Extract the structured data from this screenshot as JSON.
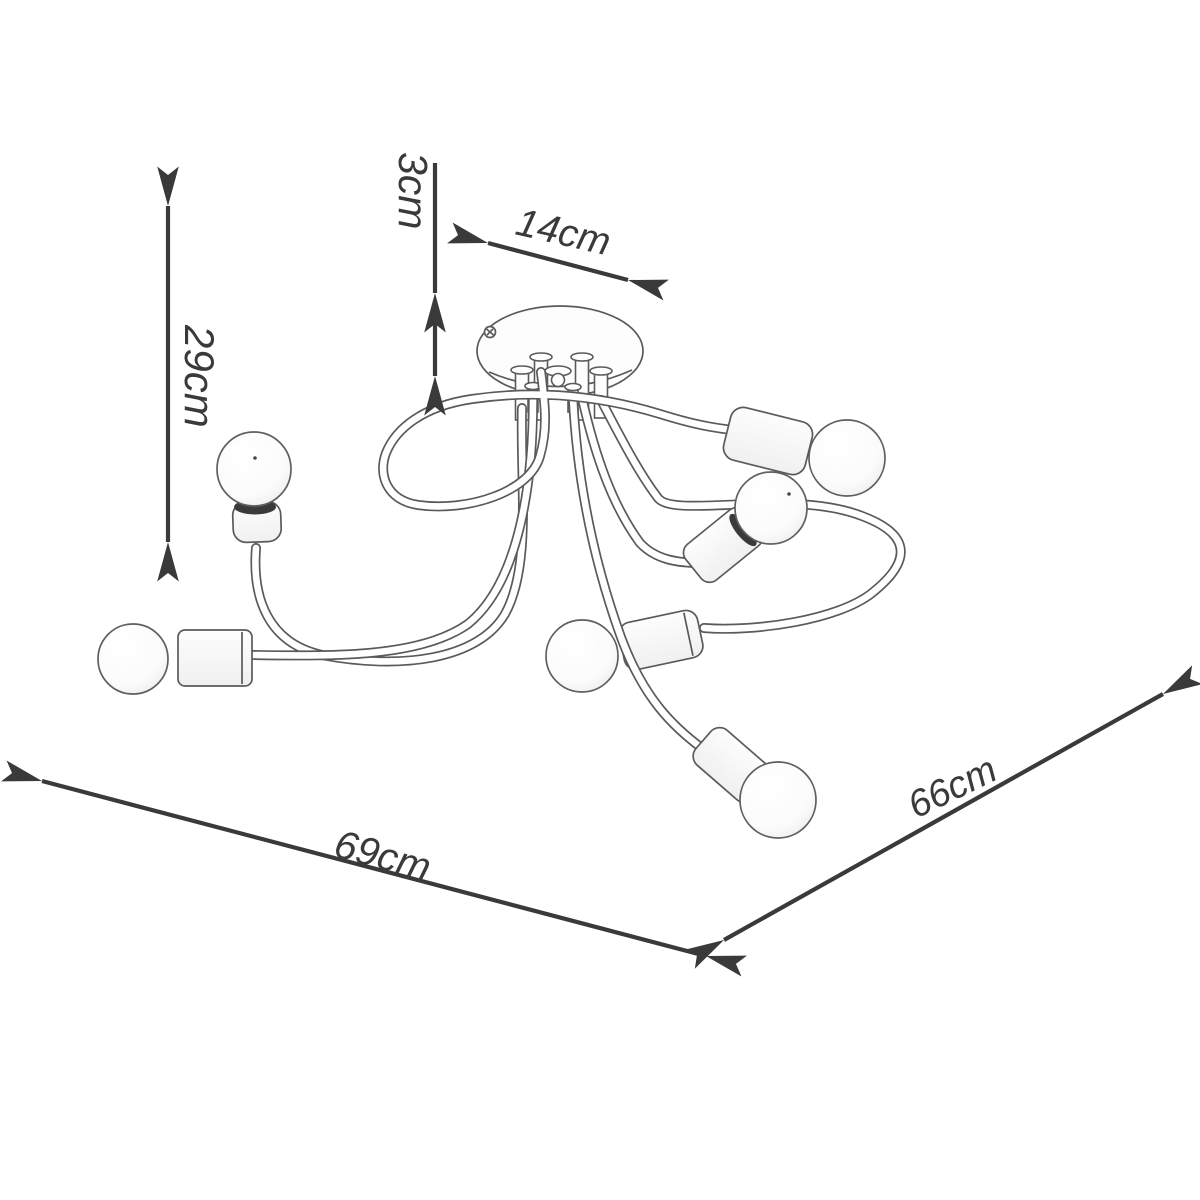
{
  "figure": {
    "bulb_count": 6
  },
  "dimensions": {
    "drop": "3cm",
    "canopy": "14cm",
    "height": "29cm",
    "width": "69cm",
    "depth": "66cm"
  },
  "colors": {
    "background": "#ffffff",
    "drawing_line": "#5a5a5a",
    "annotation": "#3a3a3a"
  }
}
